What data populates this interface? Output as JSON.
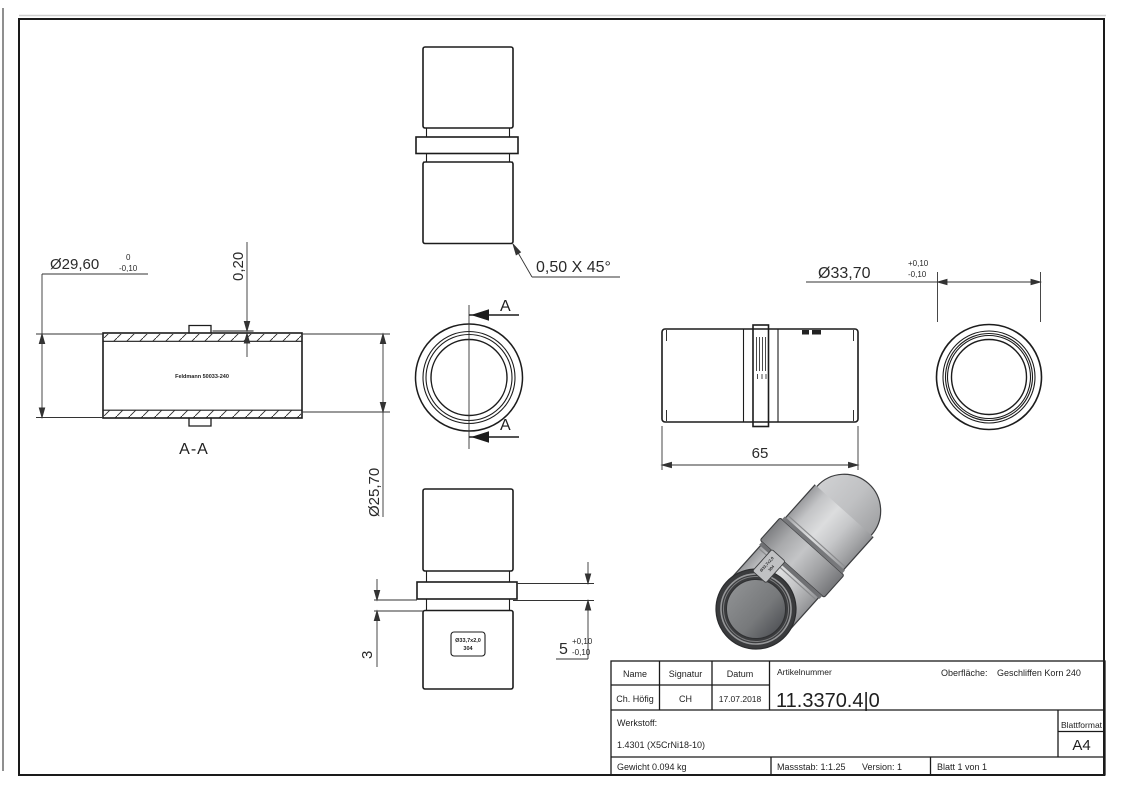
{
  "title_block": {
    "headers": {
      "name": "Name",
      "signatur": "Signatur",
      "datum": "Datum",
      "artikelnummer": "Artikelnummer",
      "oberflaeche": "Oberfläche:",
      "werkstoff": "Werkstoff:",
      "blattformat": "Blattformat"
    },
    "values": {
      "name": "Ch. Höfig",
      "signatur": "CH",
      "datum": "17.07.2018",
      "artikelnummer": "11.3370.4|0",
      "oberflaeche": "Geschliffen Korn 240",
      "werkstoff": "1.4301 (X5CrNi18-10)",
      "blattformat": "A4",
      "gewicht": "Gewicht 0.094 kg",
      "massstab": "Massstab: 1:1.25",
      "version": "Version: 1",
      "blatt": "Blatt 1 von 1"
    }
  },
  "dimensions": {
    "dia_29_60": {
      "text": "Ø29,60",
      "tol_top": "0",
      "tol_bottom": "-0,10"
    },
    "wall_0_20": "0,20",
    "chamfer": "0,50 X 45°",
    "dia_25_70": "Ø25,70",
    "dia_33_70": {
      "text": "Ø33,70",
      "tol_top": "+0,10",
      "tol_bottom": "-0,10"
    },
    "length_65": "65",
    "step_3": "3",
    "collar_5": {
      "text": "5",
      "tol_top": "+0,10",
      "tol_bottom": "-0,10"
    }
  },
  "section": {
    "arrow_label_top": "A",
    "arrow_label_bottom": "A",
    "caption": "A-A"
  },
  "markings": {
    "section_label": "Feldmann 50033-240",
    "tube_label_line1": "Ø33,7x2,0",
    "tube_label_line2": "304"
  },
  "colors": {
    "line": "#1e1e1e",
    "dim_line": "#333333",
    "body_gray": "#c8c9cb",
    "rim_dark": "#3a3b3d"
  }
}
